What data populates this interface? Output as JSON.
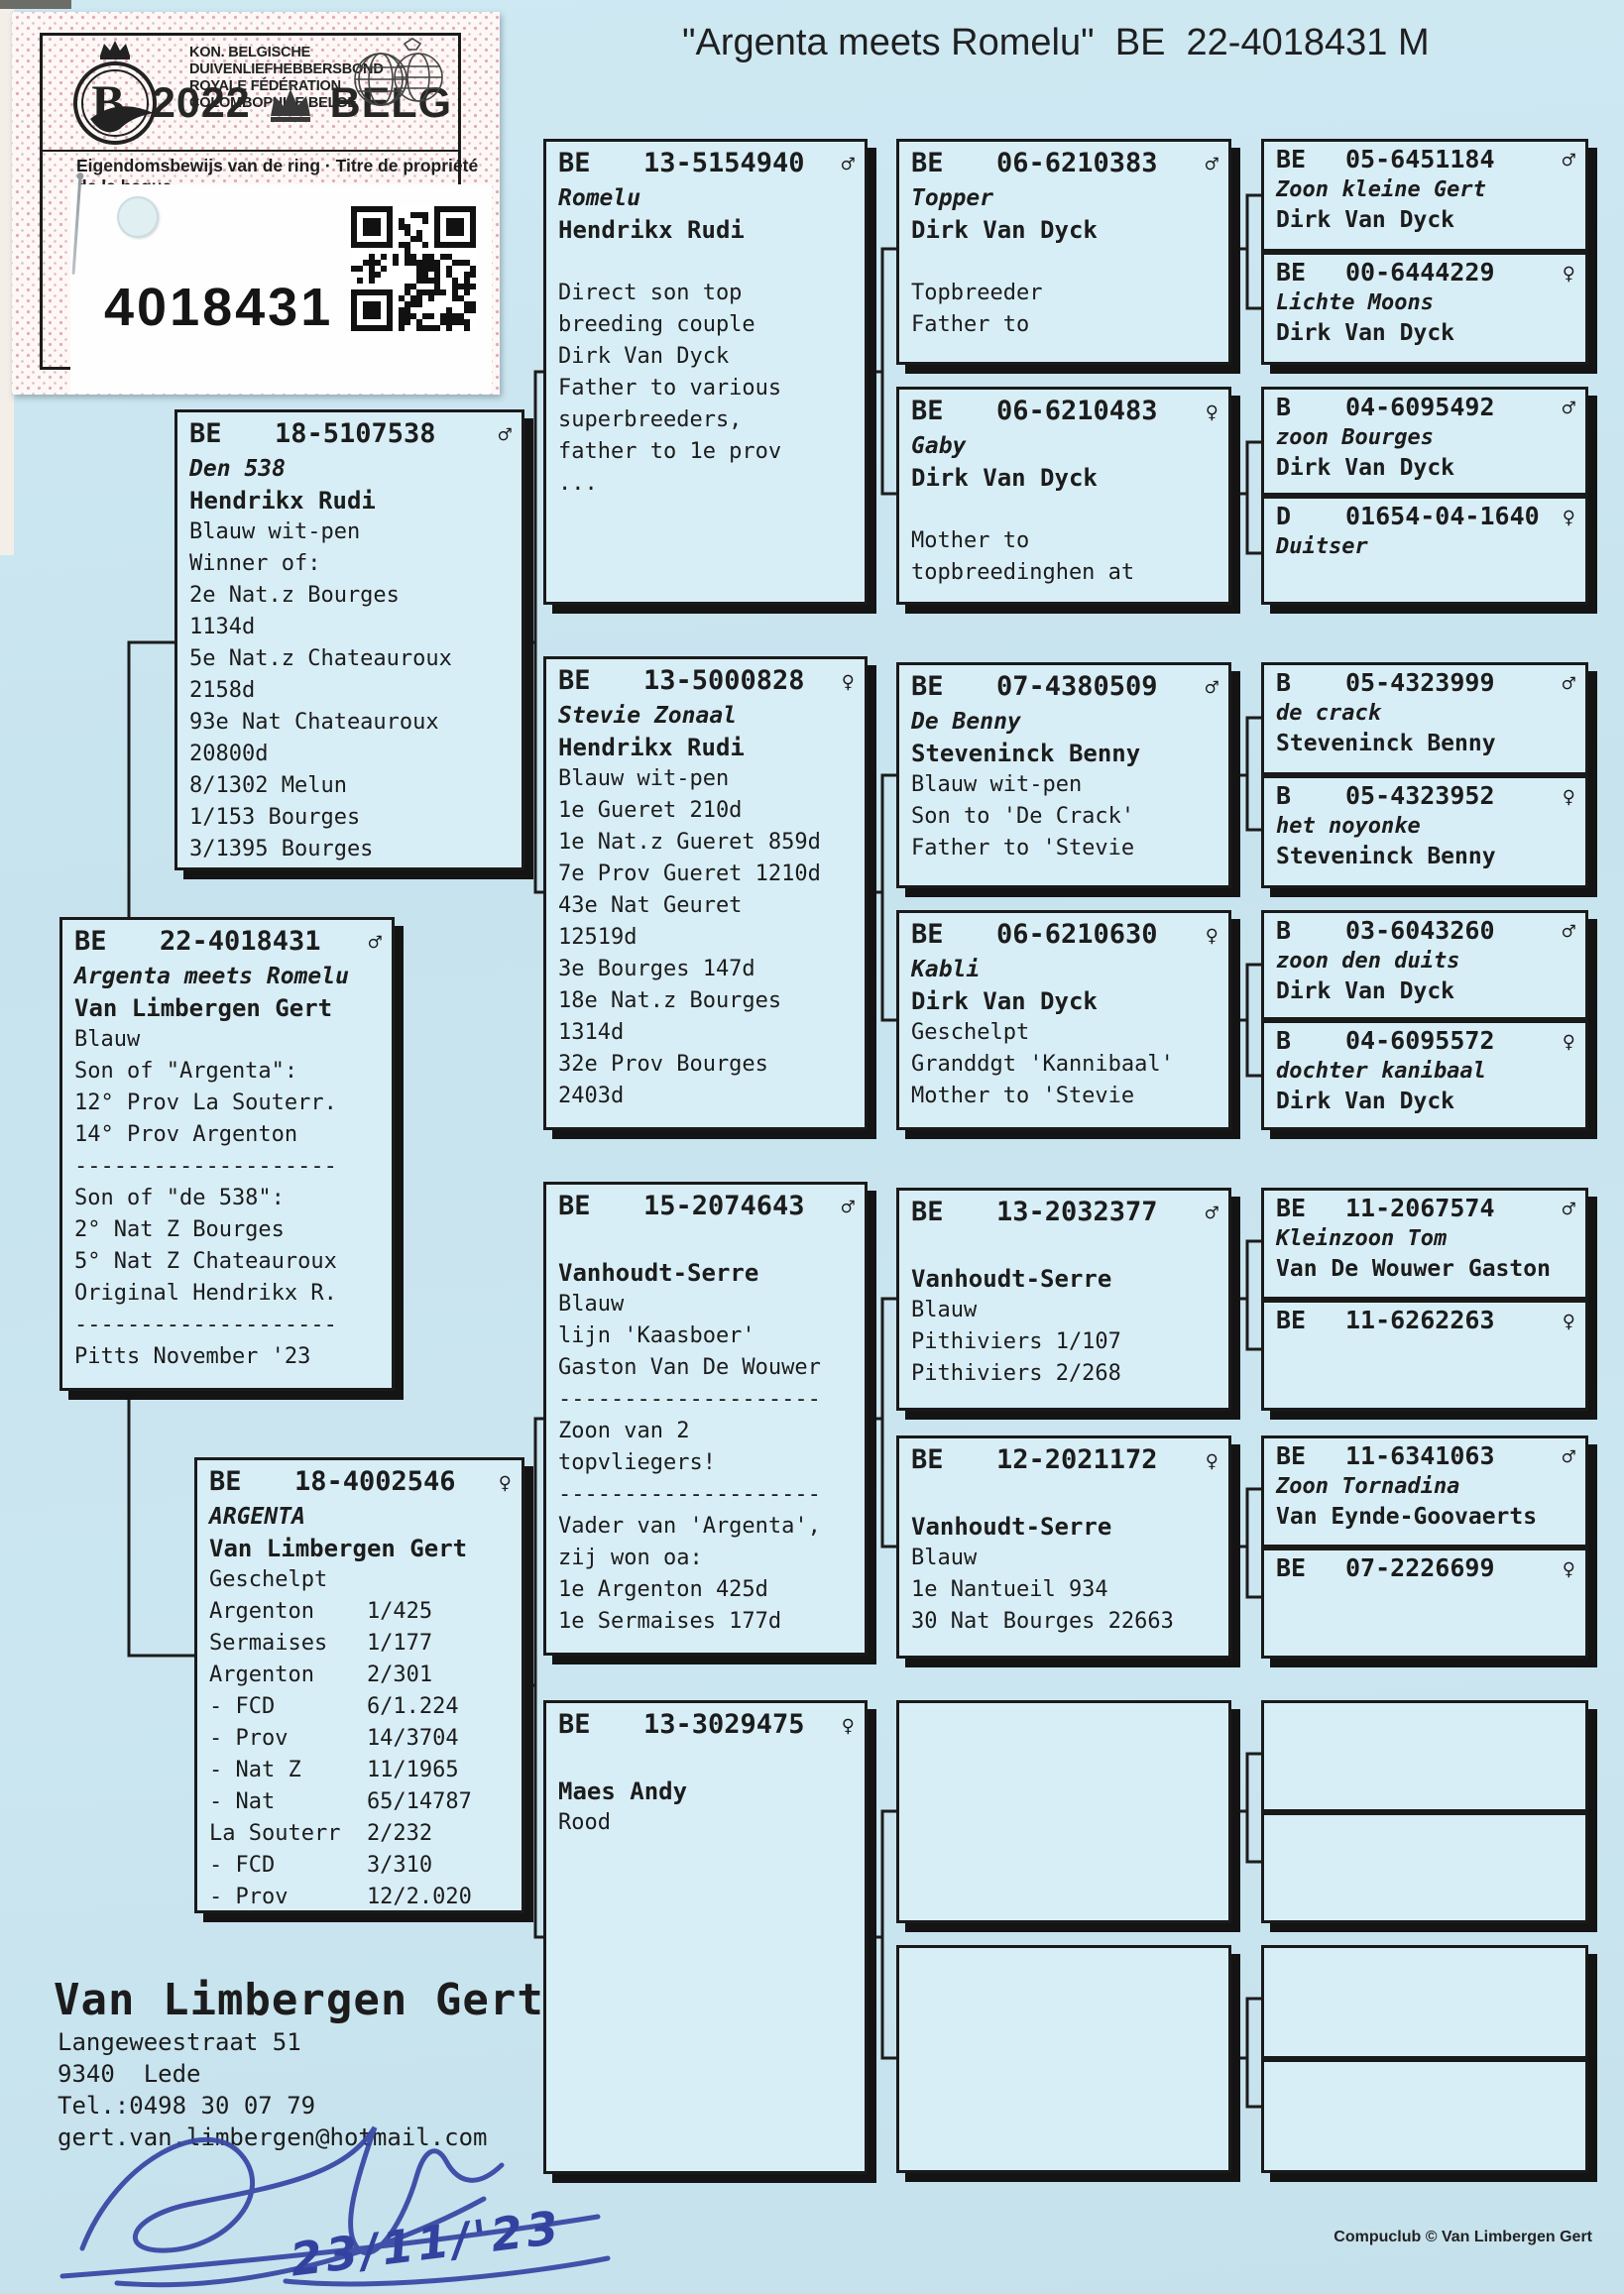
{
  "page": {
    "title": "\"Argenta meets Romelu\"  BE  22-4018431 M",
    "credit": "Compuclub © Van Limbergen Gert"
  },
  "icons": {
    "male-icon": "♂",
    "female-icon": "♀"
  },
  "sticker": {
    "federation_line1": "KON. BELGISCHE DUIVENLIEFHEBBERSBOND",
    "federation_line2": "ROYALE FÉDÉRATION COLOMBOPHILE BELGE",
    "year": "2022",
    "country": "BELG",
    "logo_letter": "B",
    "ownership_line": "Eigendomsbewijs van de ring · Titre de propriété de la bague",
    "ring_number": "4018431"
  },
  "owner": {
    "name": "Van Limbergen Gert",
    "address_line1": "Langeweestraat 51",
    "address_line2": "9340  Lede",
    "phone": "Tel.:0498 30 07 79",
    "email": "gert.van.limbergen@hotmail.com",
    "signature_date": "23/11/'23"
  },
  "pedigree": {
    "boxes": [
      {
        "id": "den538",
        "country": "BE",
        "number": "18-5107538",
        "sex": "male",
        "name": "Den 538",
        "fancier": "Hendrikx Rudi",
        "lines": [
          "Blauw wit-pen",
          "Winner of:",
          "2e Nat.z Bourges",
          "1134d",
          "5e Nat.z Chateauroux",
          "2158d",
          "93e Nat Chateauroux",
          "20800d",
          "8/1302 Melun",
          "1/153 Bourges",
          "3/1395 Bourges"
        ]
      },
      {
        "id": "subject",
        "country": "BE",
        "number": "22-4018431",
        "sex": "male",
        "name": "Argenta meets Romelu",
        "fancier": "Van Limbergen Gert",
        "lines": [
          "Blauw",
          "Son of \"Argenta\":",
          "12° Prov La Souterr.",
          "14° Prov Argenton",
          "--------------------",
          "Son of \"de 538\":",
          "2° Nat Z Bourges",
          "5° Nat Z Chateauroux",
          "Original Hendrikx R.",
          "--------------------",
          "Pitts November '23"
        ]
      },
      {
        "id": "argenta",
        "country": "BE",
        "number": "18-4002546",
        "sex": "female",
        "name": "ARGENTA",
        "fancier": "Van Limbergen Gert",
        "lines": [
          "Geschelpt",
          "Argenton    1/425",
          "Sermaises   1/177",
          "Argenton    2/301",
          "- FCD       6/1.224",
          "- Prov      14/3704",
          "- Nat Z     11/1965",
          "- Nat       65/14787",
          "La Souterr  2/232",
          "- FCD       3/310",
          "- Prov      12/2.020"
        ]
      },
      {
        "id": "romelu",
        "country": "BE",
        "number": "13-5154940",
        "sex": "male",
        "name": "Romelu",
        "fancier": "Hendrikx Rudi",
        "lines": [
          "",
          "Direct son top",
          "breeding couple",
          "Dirk Van Dyck",
          "Father to various",
          "superbreeders,",
          "father to 1e prov",
          "..."
        ]
      },
      {
        "id": "stevie",
        "country": "BE",
        "number": "13-5000828",
        "sex": "female",
        "name": "Stevie Zonaal",
        "fancier": "Hendrikx Rudi",
        "lines": [
          "Blauw wit-pen",
          "1e Gueret 210d",
          "1e Nat.z Gueret 859d",
          "7e Prov Gueret 1210d",
          "43e Nat Geuret",
          "12519d",
          "3e Bourges 147d",
          "18e Nat.z Bourges",
          "1314d",
          "32e Prov Bourges",
          "2403d"
        ]
      },
      {
        "id": "vhsire",
        "country": "BE",
        "number": "15-2074643",
        "sex": "male",
        "name": "",
        "fancier": "Vanhoudt-Serre",
        "lines": [
          "Blauw",
          "lijn 'Kaasboer'",
          "Gaston Van De Wouwer",
          "--------------------",
          "Zoon van 2",
          "topvliegers!",
          "--------------------",
          "Vader van 'Argenta',",
          "zij won oa:",
          "1e Argenton 425d",
          "1e Sermaises 177d"
        ]
      },
      {
        "id": "maes",
        "country": "BE",
        "number": "13-3029475",
        "sex": "female",
        "name": "",
        "fancier": "Maes Andy",
        "lines": [
          "Rood"
        ]
      },
      {
        "id": "topper",
        "country": "BE",
        "number": "06-6210383",
        "sex": "male",
        "name": "Topper",
        "fancier": "Dirk Van Dyck",
        "lines": [
          "",
          "Topbreeder",
          "Father to"
        ]
      },
      {
        "id": "gaby",
        "country": "BE",
        "number": "06-6210483",
        "sex": "female",
        "name": "Gaby",
        "fancier": "Dirk Van Dyck",
        "lines": [
          "",
          "Mother to",
          "topbreedinghen at"
        ]
      },
      {
        "id": "debenny",
        "country": "BE",
        "number": "07-4380509",
        "sex": "male",
        "name": "De Benny",
        "fancier": "Steveninck Benny",
        "lines": [
          "Blauw wit-pen",
          "Son to 'De Crack'",
          "Father to 'Stevie"
        ]
      },
      {
        "id": "kabli",
        "country": "BE",
        "number": "06-6210630",
        "sex": "female",
        "name": "Kabli",
        "fancier": "Dirk Van Dyck",
        "lines": [
          "Geschelpt",
          "Granddgt 'Kannibaal'",
          "Mother to 'Stevie"
        ]
      },
      {
        "id": "vh2",
        "country": "BE",
        "number": "13-2032377",
        "sex": "male",
        "name": "",
        "fancier": "Vanhoudt-Serre",
        "lines": [
          "Blauw",
          "Pithiviers 1/107",
          "Pithiviers 2/268"
        ]
      },
      {
        "id": "vh3",
        "country": "BE",
        "number": "12-2021172",
        "sex": "female",
        "name": "",
        "fancier": "Vanhoudt-Serre",
        "lines": [
          "Blauw",
          "1e Nantueil 934",
          "30 Nat Bourges 22663"
        ]
      },
      {
        "id": "e3a",
        "country": "",
        "number": "",
        "sex": "",
        "name": "",
        "fancier": "",
        "lines": []
      },
      {
        "id": "e3b",
        "country": "",
        "number": "",
        "sex": "",
        "name": "",
        "fancier": "",
        "lines": []
      }
    ],
    "pairs": [
      {
        "id": "p1",
        "slots": [
          {
            "id": "b6451184",
            "country": "BE",
            "number": "05-6451184",
            "sex": "male",
            "name": "Zoon kleine Gert",
            "fancier": "Dirk Van Dyck"
          },
          {
            "id": "b6444229",
            "country": "BE",
            "number": "00-6444229",
            "sex": "female",
            "name": "Lichte Moons",
            "fancier": "Dirk Van Dyck"
          }
        ]
      },
      {
        "id": "p2",
        "slots": [
          {
            "id": "b6095492",
            "country": "B",
            "number": "04-6095492",
            "sex": "male",
            "name": "zoon Bourges",
            "fancier": "Dirk Van Dyck"
          },
          {
            "id": "d1640",
            "country": "D",
            "number": "01654-04-1640",
            "sex": "female",
            "name": "Duitser",
            "fancier": ""
          }
        ]
      },
      {
        "id": "p3",
        "slots": [
          {
            "id": "b4323999",
            "country": "B",
            "number": "05-4323999",
            "sex": "male",
            "name": "de crack",
            "fancier": "Steveninck Benny"
          },
          {
            "id": "b4323952",
            "country": "B",
            "number": "05-4323952",
            "sex": "female",
            "name": "het noyonke",
            "fancier": "Steveninck Benny"
          }
        ]
      },
      {
        "id": "p4",
        "slots": [
          {
            "id": "b6043260",
            "country": "B",
            "number": "03-6043260",
            "sex": "male",
            "name": "zoon den duits",
            "fancier": "Dirk Van Dyck"
          },
          {
            "id": "b6095572",
            "country": "B",
            "number": "04-6095572",
            "sex": "female",
            "name": "dochter kanibaal",
            "fancier": "Dirk Van Dyck"
          }
        ]
      },
      {
        "id": "p5",
        "slots": [
          {
            "id": "b2067574",
            "country": "BE",
            "number": "11-2067574",
            "sex": "male",
            "name": "Kleinzoon Tom",
            "fancier": "Van De Wouwer Gaston"
          },
          {
            "id": "b6262263",
            "country": "BE",
            "number": "11-6262263",
            "sex": "female",
            "name": "",
            "fancier": ""
          }
        ]
      },
      {
        "id": "p6",
        "slots": [
          {
            "id": "b6341063",
            "country": "BE",
            "number": "11-6341063",
            "sex": "male",
            "name": "Zoon Tornadina",
            "fancier": "Van Eynde-Goovaerts"
          },
          {
            "id": "b2226699",
            "country": "BE",
            "number": "07-2226699",
            "sex": "female",
            "name": "",
            "fancier": ""
          }
        ]
      },
      {
        "id": "p7",
        "slots": [
          {
            "id": "e4a",
            "country": "",
            "number": "",
            "sex": "",
            "name": "",
            "fancier": ""
          },
          {
            "id": "e4b",
            "country": "",
            "number": "",
            "sex": "",
            "name": "",
            "fancier": ""
          }
        ]
      },
      {
        "id": "p8",
        "slots": [
          {
            "id": "e4c",
            "country": "",
            "number": "",
            "sex": "",
            "name": "",
            "fancier": ""
          },
          {
            "id": "e4d",
            "country": "",
            "number": "",
            "sex": "",
            "name": "",
            "fancier": ""
          }
        ]
      }
    ]
  }
}
